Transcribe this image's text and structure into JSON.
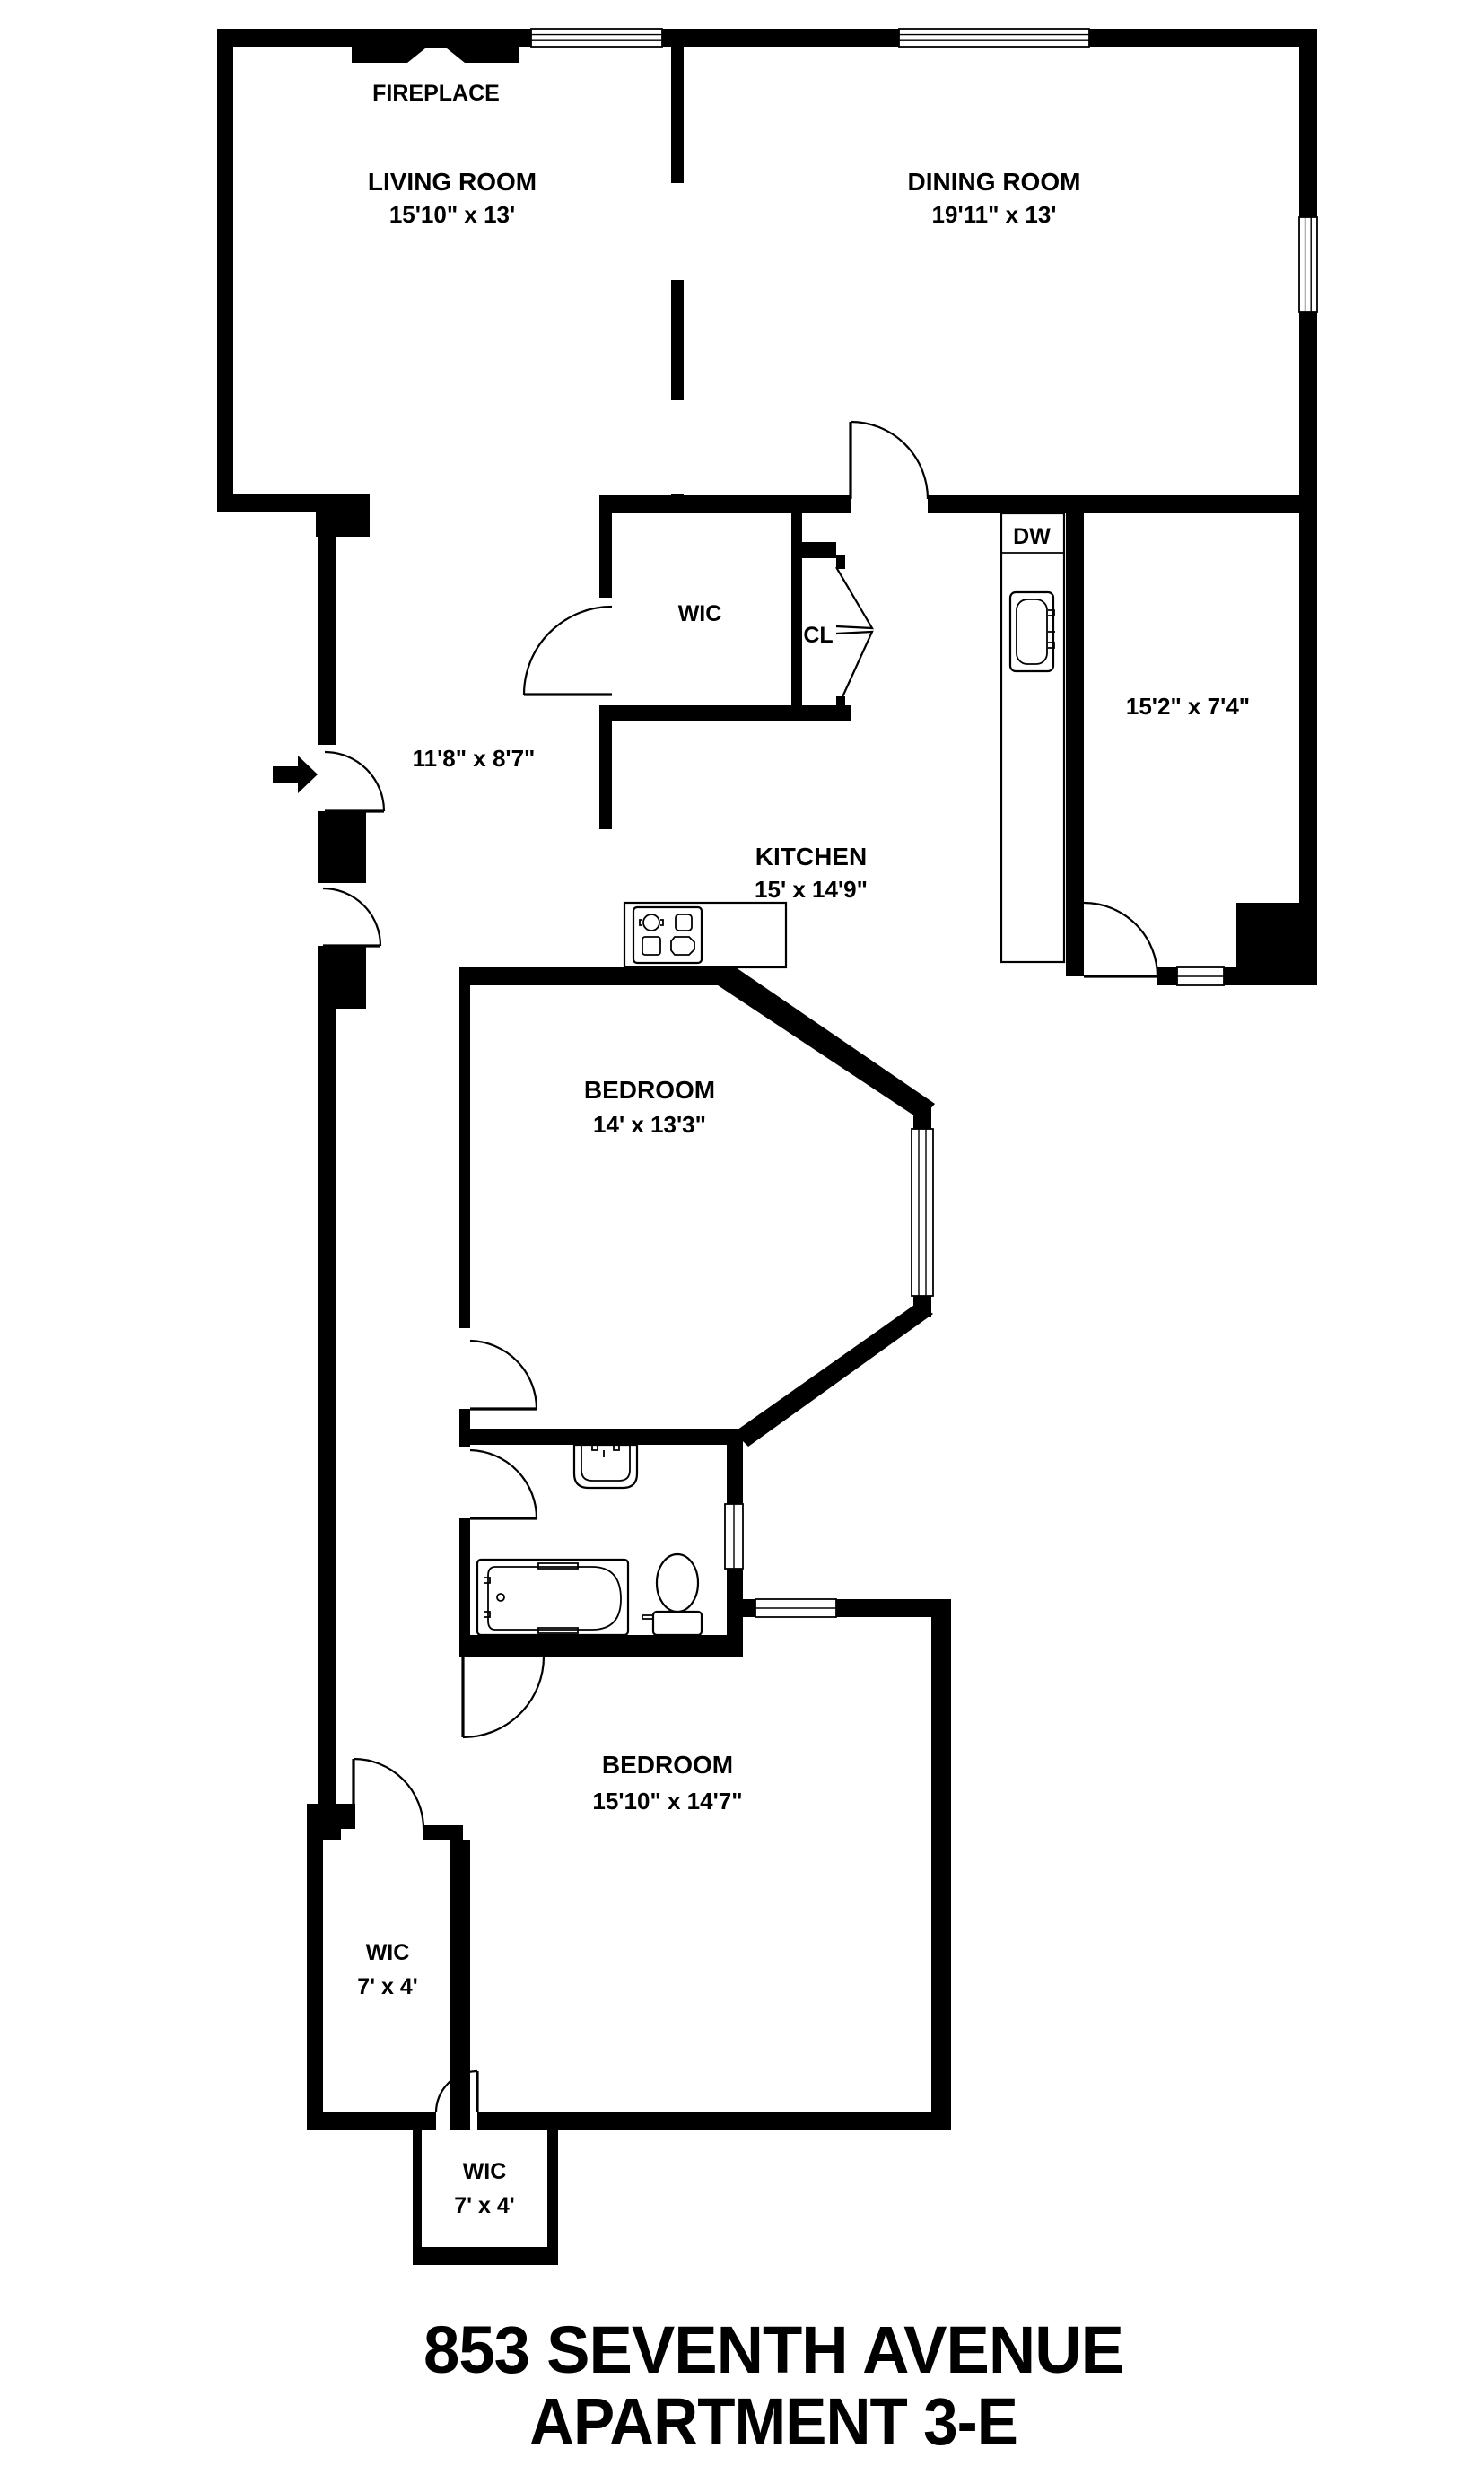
{
  "title": {
    "line1": "853 SEVENTH AVENUE",
    "line2": "APARTMENT 3-E"
  },
  "rooms": {
    "living_room": {
      "name": "LIVING ROOM",
      "dims": "15'10\" x 13'"
    },
    "dining_room": {
      "name": "DINING ROOM",
      "dims": "19'11\" x 13'"
    },
    "kitchen": {
      "name": "KITCHEN",
      "dims": "15' x 14'9\""
    },
    "hallway": {
      "dims": "11'8\" x 8'7\""
    },
    "side_room": {
      "dims": "15'2\" x 7'4\""
    },
    "bedroom_1": {
      "name": "BEDROOM",
      "dims": "14' x 13'3\""
    },
    "bedroom_2": {
      "name": "BEDROOM",
      "dims": "15'10\" x 14'7\""
    },
    "wic_top": {
      "name": "WIC"
    },
    "closet": {
      "name": "CL"
    },
    "dishwasher": {
      "name": "DW"
    },
    "wic_left": {
      "name": "WIC",
      "dims": "7' x 4'"
    },
    "wic_bottom": {
      "name": "WIC",
      "dims": "7' x 4'"
    }
  },
  "fixtures": {
    "fireplace_label": "FIREPLACE"
  },
  "colors": {
    "wall": "#000000",
    "background": "#ffffff"
  }
}
